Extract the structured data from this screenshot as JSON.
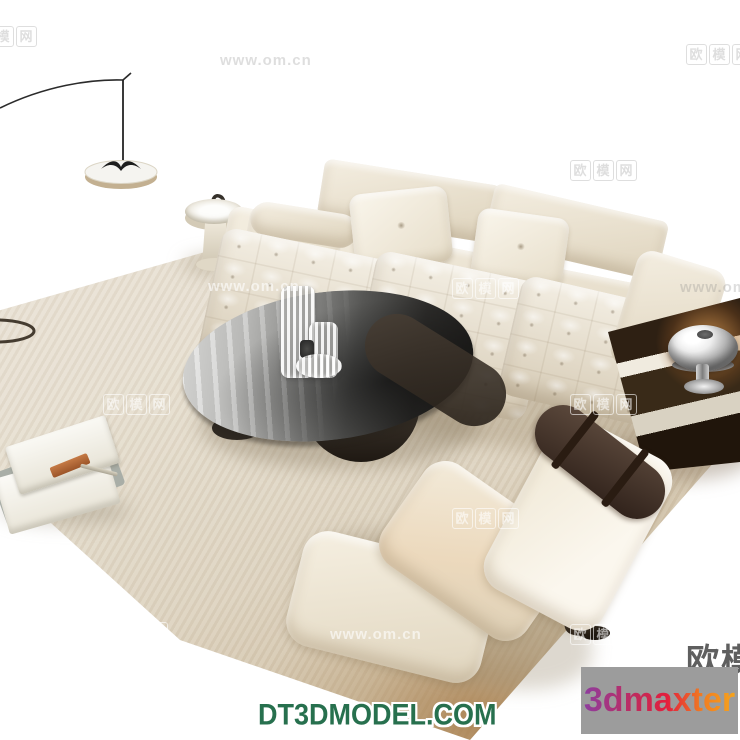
{
  "watermarks": {
    "site_name": "欧模网",
    "site_url": "www.om.cn",
    "tiles": [
      {
        "text": "欧模网",
        "style": "boxed",
        "x": -30,
        "y": 26,
        "variant": "dark"
      },
      {
        "text": "www.om.cn",
        "style": "plain",
        "x": 220,
        "y": 52,
        "variant": "dark"
      },
      {
        "text": "欧模网",
        "style": "boxed",
        "x": 686,
        "y": 44,
        "variant": "dark"
      },
      {
        "text": "欧模网",
        "style": "boxed",
        "x": 570,
        "y": 160,
        "variant": "dark"
      },
      {
        "text": "欧模网",
        "style": "boxed",
        "x": -34,
        "y": 276,
        "variant": "light"
      },
      {
        "text": "www.om.cn",
        "style": "plain",
        "x": 208,
        "y": 278,
        "variant": "light"
      },
      {
        "text": "欧模网",
        "style": "boxed",
        "x": 452,
        "y": 278,
        "variant": "light"
      },
      {
        "text": "www.om.cn",
        "style": "plain",
        "x": 680,
        "y": 279,
        "variant": "dark"
      },
      {
        "text": "欧模网",
        "style": "boxed",
        "x": 103,
        "y": 394,
        "variant": "light"
      },
      {
        "text": "欧模网",
        "style": "boxed",
        "x": 570,
        "y": 394,
        "variant": "light"
      },
      {
        "text": "欧模网",
        "style": "boxed",
        "x": 452,
        "y": 508,
        "variant": "light"
      },
      {
        "text": "欧模网",
        "style": "boxed",
        "x": 101,
        "y": 622,
        "variant": "light"
      },
      {
        "text": "www.om.cn",
        "style": "plain",
        "x": 330,
        "y": 626,
        "variant": "light"
      },
      {
        "text": "欧模网",
        "style": "boxed",
        "x": 570,
        "y": 624,
        "variant": "light"
      }
    ]
  },
  "branding": {
    "corner_brand": "欧模",
    "model_site_label": "DT3DMODEL.COM",
    "logo_label": "3dmaxter"
  },
  "palette": {
    "floor": "#ffffff",
    "rug_light": "#ece6db",
    "rug_corner_tan": "#ac8a5e",
    "sofa_cream": "#ece4d2",
    "table_glass_dark": "#1d1c1a",
    "wood_dark": "#2e2013",
    "bolster_brown": "#3a2a1f",
    "brand_green": "#27704e",
    "logo_box_gray": "#9c9c9c"
  }
}
